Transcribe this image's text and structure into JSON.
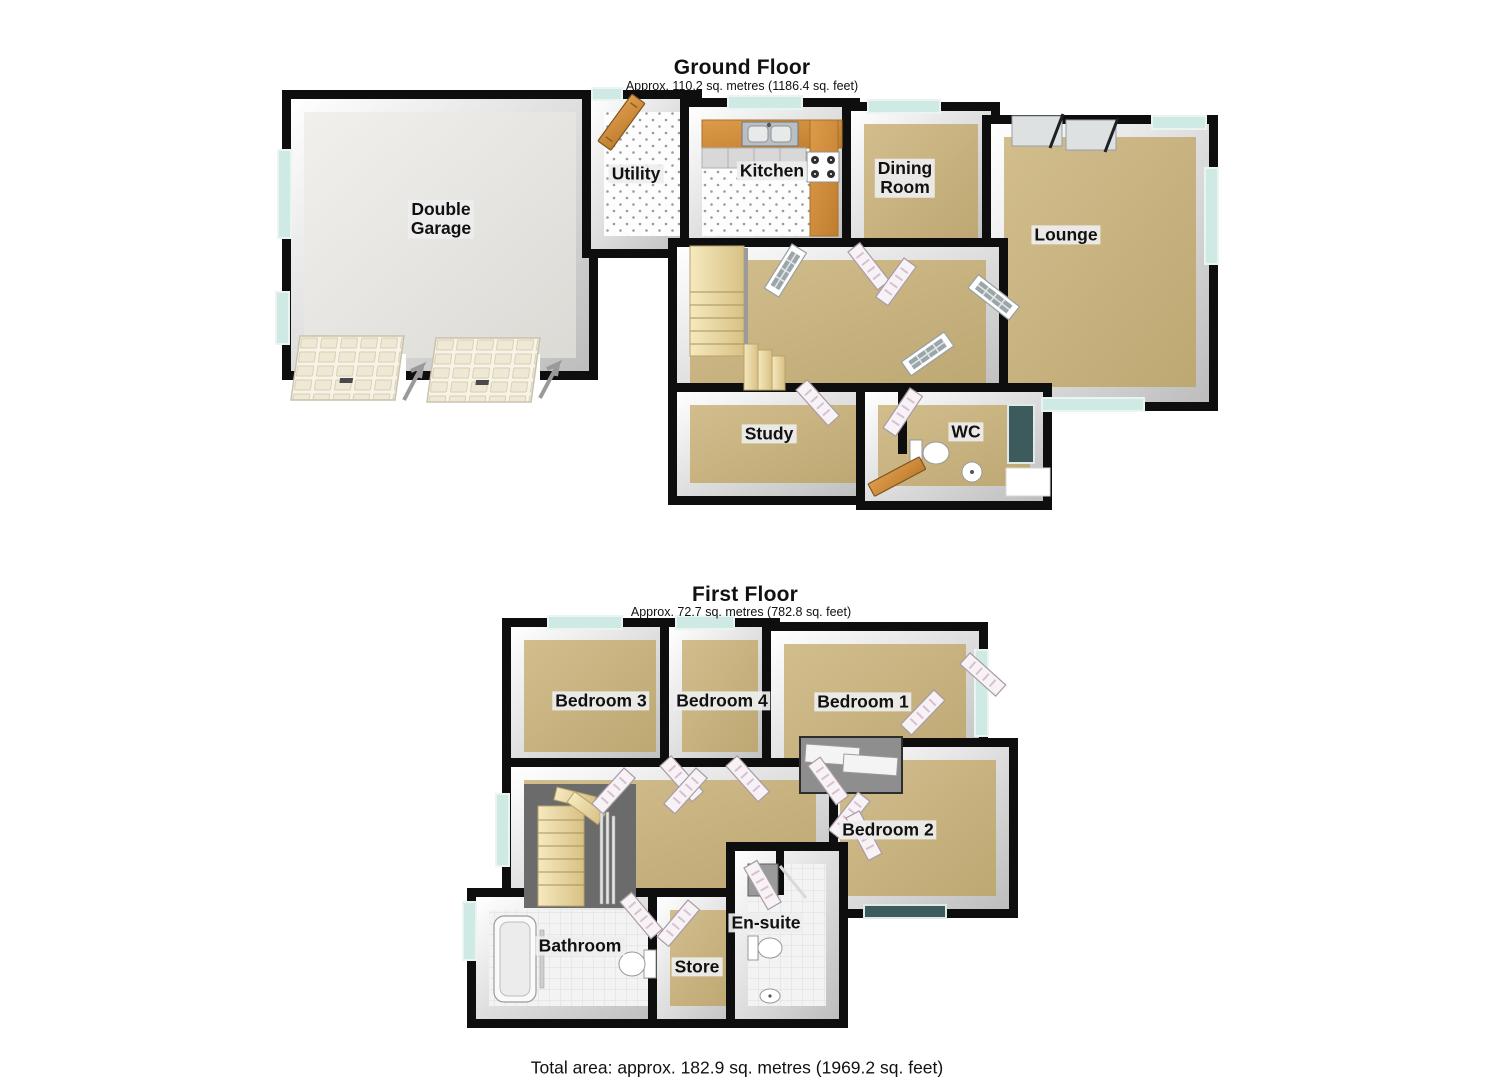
{
  "floors": [
    {
      "id": "ground-floor",
      "title": "Ground Floor",
      "subtitle": "Approx. 110.2 sq. metres (1186.4 sq. feet)",
      "rooms": [
        {
          "id": "double-garage",
          "label": "Double\nGarage"
        },
        {
          "id": "utility",
          "label": "Utility"
        },
        {
          "id": "kitchen",
          "label": "Kitchen"
        },
        {
          "id": "dining-room",
          "label": "Dining\nRoom"
        },
        {
          "id": "lounge",
          "label": "Lounge"
        },
        {
          "id": "study",
          "label": "Study"
        },
        {
          "id": "wc",
          "label": "WC"
        }
      ]
    },
    {
      "id": "first-floor",
      "title": "First Floor",
      "subtitle": "Approx. 72.7 sq. metres (782.8 sq. feet)",
      "rooms": [
        {
          "id": "bedroom-3",
          "label": "Bedroom 3"
        },
        {
          "id": "bedroom-4",
          "label": "Bedroom 4"
        },
        {
          "id": "bedroom-1",
          "label": "Bedroom 1"
        },
        {
          "id": "bedroom-2",
          "label": "Bedroom 2"
        },
        {
          "id": "bathroom",
          "label": "Bathroom"
        },
        {
          "id": "store",
          "label": "Store"
        },
        {
          "id": "en-suite",
          "label": "En-suite"
        }
      ]
    }
  ],
  "footer": {
    "total_area": "Total area: approx. 182.9 sq. metres (1969.2 sq. feet)"
  },
  "colors": {
    "wall": "#0e0e0e",
    "face_light": "#ffffff",
    "face_dark": "#bdbdbd",
    "carpet": "#d2bd8d",
    "carpet_dark": "#bda873",
    "stairs": "#f5e9bf",
    "stairs_dark": "#d8c184",
    "wood": "#dd9b4a",
    "wood_dark": "#bf7e2e",
    "window_glass": "#cfe9e4",
    "dark_glass": "#3d5a5c",
    "tile": "#f3f3f3",
    "tile_line": "#dcdcdc",
    "garage_floor": "#f1f0ed",
    "garage_floor_dark": "#dbdad5",
    "label_bg": "#eeeeee"
  }
}
